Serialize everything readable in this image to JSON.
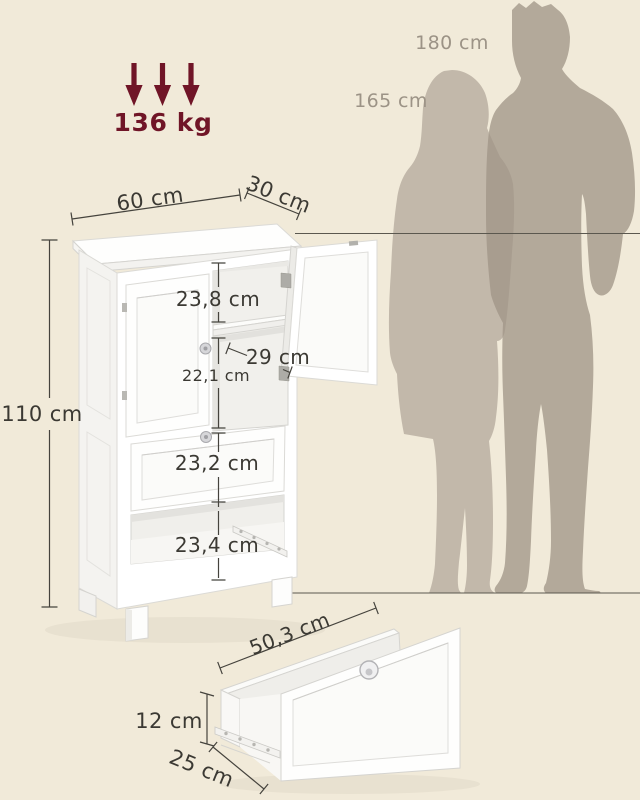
{
  "load_capacity": "136 kg",
  "scale_reference": {
    "tall": "180 cm",
    "short": "165 cm"
  },
  "cabinet": {
    "width": "60 cm",
    "depth": "30 cm",
    "height": "110 cm",
    "above_shelf": "23,8 cm",
    "shelf_depth": "29 cm",
    "below_shelf": "22,1 cm",
    "drawer_front": "23,2 cm",
    "open_compartment": "23,4 cm"
  },
  "pullout_drawer": {
    "width": "50,3 cm",
    "height": "12 cm",
    "depth": "25 cm"
  },
  "colors": {
    "background": "#f1ead9",
    "accent": "#701527",
    "dimension_text": "#3b3933",
    "reference_text": "#9c9386",
    "silhouette_man": "#b3a99a",
    "silhouette_woman": "#c2b8aa"
  }
}
